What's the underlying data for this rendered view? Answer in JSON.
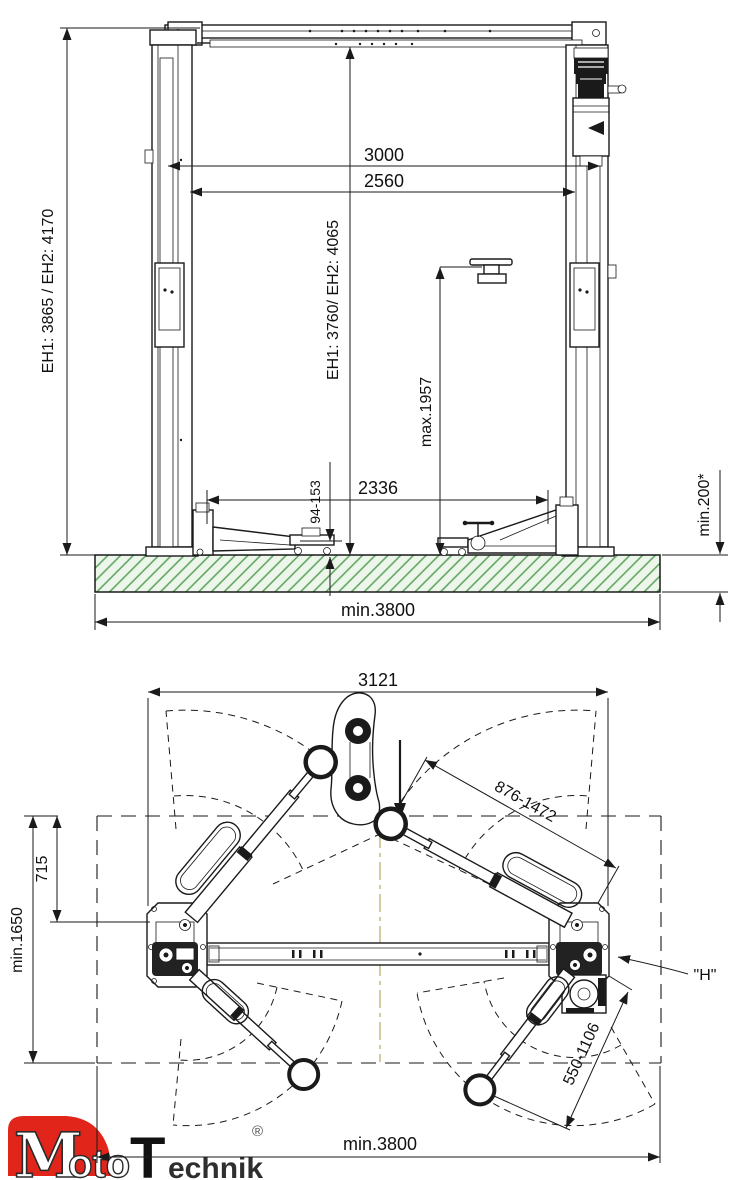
{
  "front_view": {
    "dims": {
      "total_height": "EH1: 3865 / EH2: 4170",
      "clear_height": "EH1: 3760/ EH2: 4065",
      "width_overall_posts": "3000",
      "width_clear": "2560",
      "lift_height_max": "max.1957",
      "width_between_carriages": "2336",
      "pad_min_height": "94-153",
      "foundation_depth": "min.200*",
      "bay_width": "min.3800"
    }
  },
  "plan_view": {
    "dims": {
      "base_plate_span": "3121",
      "long_arm_reach": "876-1472",
      "short_arm_reach": "550-1106",
      "drive_lane_offset": "715",
      "bay_depth": "min.1650",
      "bay_width": "min.3800"
    },
    "labels": {
      "detail_h": "\"H\""
    }
  },
  "logo": {
    "part_m": "M",
    "part_oto": "oto",
    "part_t": "T",
    "part_echnik": "echnik",
    "registered": "®"
  },
  "colors": {
    "floor_fill": "#edf6ea",
    "floor_hatch": "#5ba05b",
    "centerline": "#b4ab63",
    "logo_red": "#e1251b",
    "ink": "#1a1a1a"
  }
}
